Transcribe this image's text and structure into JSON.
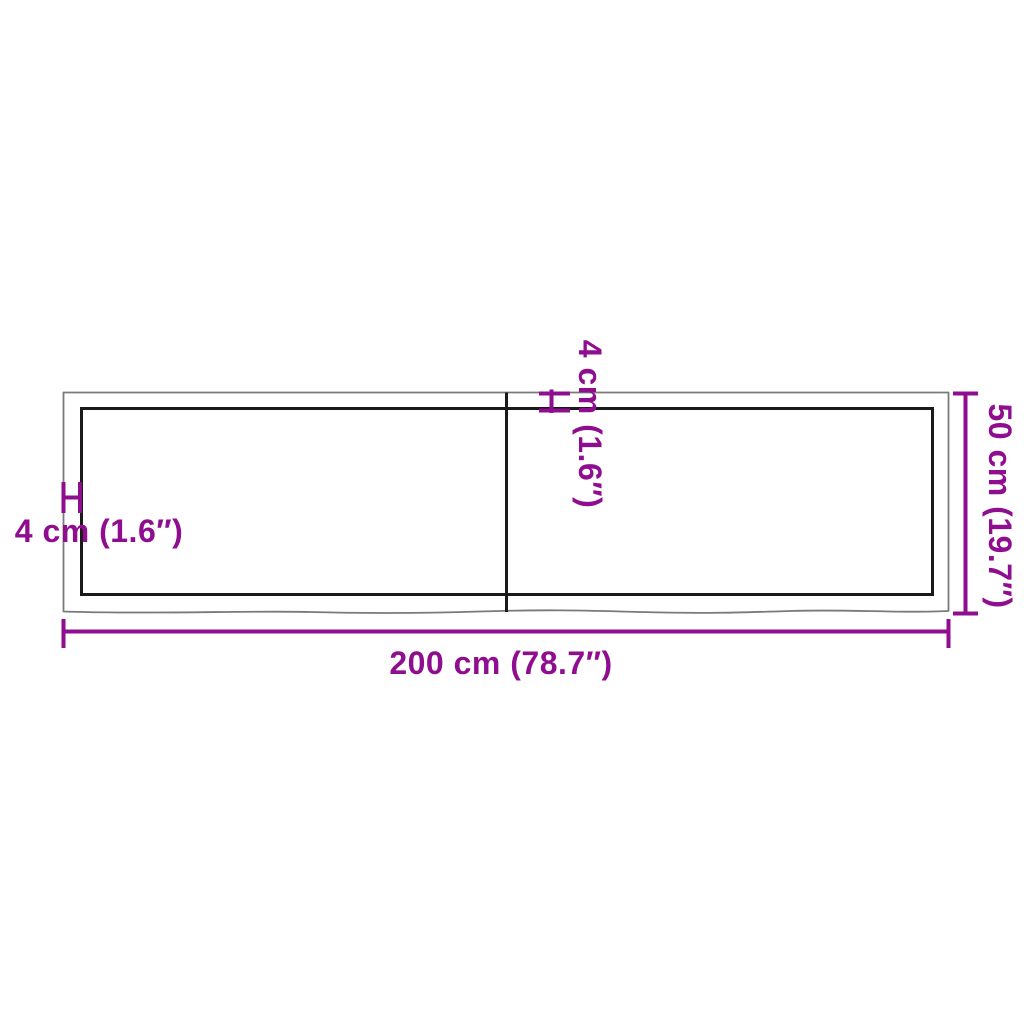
{
  "diagram": {
    "accent_color": "#8F0D8F",
    "outer_outline_color": "#7A7A7A",
    "inner_outline_color": "#1A1A1A",
    "background_color": "#FFFFFF",
    "labels": {
      "width": "200 cm (78.7″)",
      "height": "50 cm (19.7″)",
      "thickness_left": "4 cm (1.6″)",
      "thickness_center": "4 cm (1.6″)"
    }
  }
}
